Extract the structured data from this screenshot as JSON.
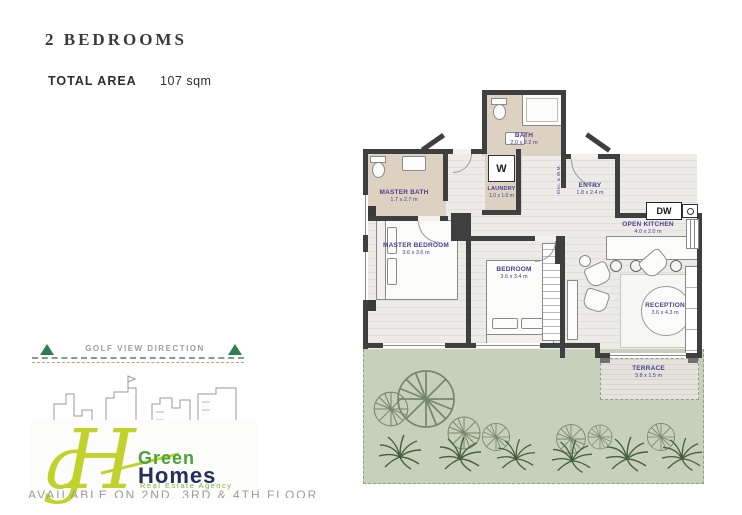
{
  "header": {
    "title": "2 BEDROOMS",
    "area_label": "TOTAL AREA",
    "area_value": "107 sqm"
  },
  "plan": {
    "rooms": {
      "bath": {
        "label": "BATH",
        "dims": "2.0 x 2.2 m"
      },
      "master_bath": {
        "label": "MASTER BATH",
        "dims": "1.7 x 2.7 m"
      },
      "laundry": {
        "label": "LAUNDRY",
        "dims": "1.0 x 1.0 m"
      },
      "entry": {
        "label": "ENTRY",
        "dims": "1.8 x 2.4 m"
      },
      "open_kitchen": {
        "label": "OPEN KITCHEN",
        "dims": "4.0 x 2.0 m"
      },
      "master_bedroom": {
        "label": "MASTER BEDROOM",
        "dims": "3.6 x 3.6 m"
      },
      "bedroom": {
        "label": "BEDROOM",
        "dims": "3.6 x 3.4 m"
      },
      "reception": {
        "label": "RECEPTION",
        "dims": "3.6 x 4.3 m"
      },
      "terrace": {
        "label": "TERRACE",
        "dims": "3.8 x 1.5 m"
      }
    },
    "appliances": {
      "washer": "W",
      "dishwasher": "DW"
    },
    "meters_label": "Elec. & W.M."
  },
  "golf_view": {
    "label": "GOLF VIEW DIRECTION"
  },
  "logo": {
    "monogram_g": "g",
    "monogram_h": "H",
    "name_line1": "Green",
    "name_line2": "Homes",
    "tagline": "Real Estate Agency"
  },
  "footer": {
    "caption": "AVAILABLE ON 2ND, 3RD & 4TH FLOOR"
  },
  "colors": {
    "accent_green": "#2e7d4f",
    "logo_chartreuse": "#c0d22b",
    "logo_navy": "#25305a",
    "label_purple": "#4a3f8f",
    "garden_green": "#c7d0bb",
    "wall_dark": "#3f3f3f"
  }
}
